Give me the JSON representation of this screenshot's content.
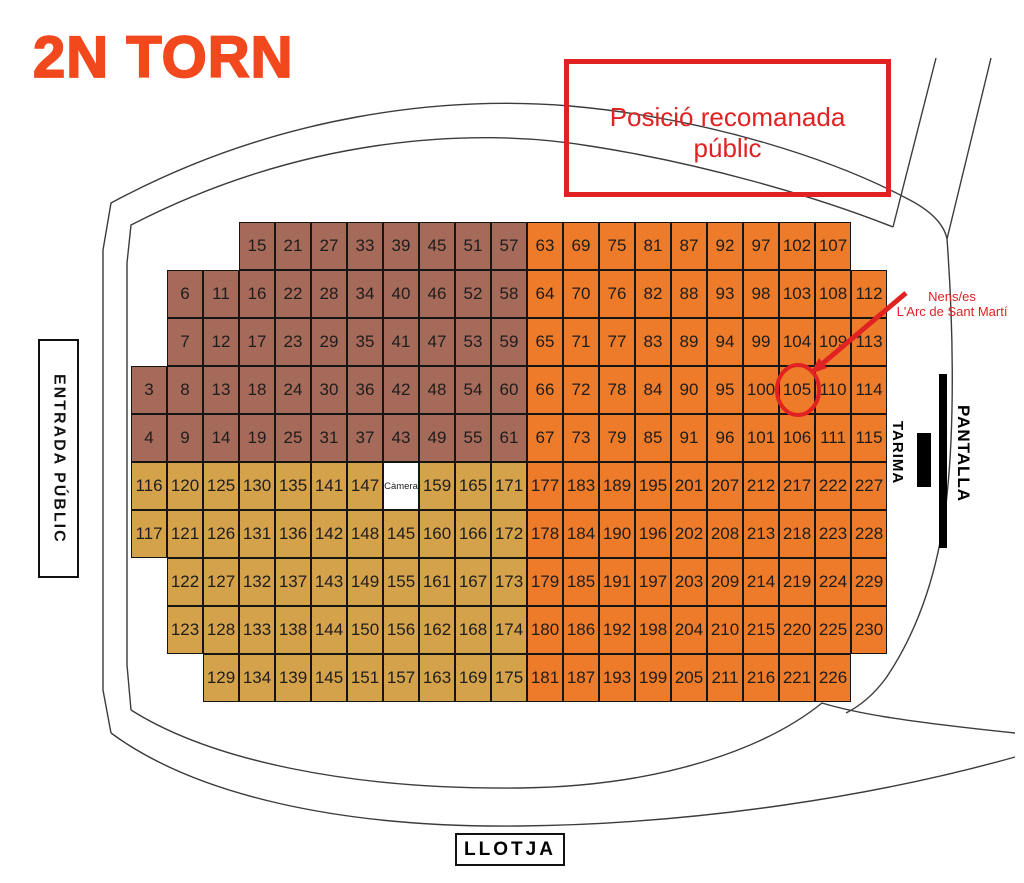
{
  "title": "2N TORN",
  "annotations": {
    "recommended_box": "Posició recomanada públic",
    "nens_line1": "Nens/es",
    "nens_line2": "L'Arc de Sant Martí",
    "circled_seat": "105"
  },
  "labels": {
    "entrance": "ENTRADA PÚBLIC",
    "tarima": "TARIMA",
    "pantalla": "PANTALLA",
    "llotja": "LLOTJA",
    "camera": "Càmera"
  },
  "colors": {
    "title": "#f2481d",
    "red": "#e02222",
    "brown": "#a66a5a",
    "orange": "#ee7b2a",
    "tan": "#d3a24b",
    "outline": "#3c3c3c"
  },
  "grid": {
    "x0": 131,
    "y0": 222,
    "cw": 36,
    "rh": 48,
    "orange_from_col": 11,
    "brown_rows": 5,
    "rows": [
      {
        "start": 3,
        "cells": [
          "15",
          "21",
          "27",
          "33",
          "39",
          "45",
          "51",
          "57",
          "63",
          "69",
          "75",
          "81",
          "87",
          "92",
          "97",
          "102",
          "107"
        ]
      },
      {
        "start": 1,
        "cells": [
          "6",
          "11",
          "16",
          "22",
          "28",
          "34",
          "40",
          "46",
          "52",
          "58",
          "64",
          "70",
          "76",
          "82",
          "88",
          "93",
          "98",
          "103",
          "108",
          "112"
        ]
      },
      {
        "start": 1,
        "cells": [
          "7",
          "12",
          "17",
          "23",
          "29",
          "35",
          "41",
          "47",
          "53",
          "59",
          "65",
          "71",
          "77",
          "83",
          "89",
          "94",
          "99",
          "104",
          "109",
          "113"
        ]
      },
      {
        "start": 0,
        "cells": [
          "3",
          "8",
          "13",
          "18",
          "24",
          "30",
          "36",
          "42",
          "48",
          "54",
          "60",
          "66",
          "72",
          "78",
          "84",
          "90",
          "95",
          "100",
          "105",
          "110",
          "114"
        ]
      },
      {
        "start": 0,
        "cells": [
          "4",
          "9",
          "14",
          "19",
          "25",
          "31",
          "37",
          "43",
          "49",
          "55",
          "61",
          "67",
          "73",
          "79",
          "85",
          "91",
          "96",
          "101",
          "106",
          "111",
          "115"
        ]
      },
      {
        "start": 0,
        "cells": [
          "116",
          "120",
          "125",
          "130",
          "135",
          "141",
          "147",
          "@camera",
          "159",
          "165",
          "171",
          "177",
          "183",
          "189",
          "195",
          "201",
          "207",
          "212",
          "217",
          "222",
          "227"
        ]
      },
      {
        "start": 0,
        "cells": [
          "117",
          "121",
          "126",
          "131",
          "136",
          "142",
          "148",
          "145",
          "160",
          "166",
          "172",
          "178",
          "184",
          "190",
          "196",
          "202",
          "208",
          "213",
          "218",
          "223",
          "228"
        ]
      },
      {
        "start": 1,
        "cells": [
          "122",
          "127",
          "132",
          "137",
          "143",
          "149",
          "155",
          "161",
          "167",
          "173",
          "179",
          "185",
          "191",
          "197",
          "203",
          "209",
          "214",
          "219",
          "224",
          "229"
        ]
      },
      {
        "start": 1,
        "cells": [
          "123",
          "128",
          "133",
          "138",
          "144",
          "150",
          "156",
          "162",
          "168",
          "174",
          "180",
          "186",
          "192",
          "198",
          "204",
          "210",
          "215",
          "220",
          "225",
          "230"
        ]
      },
      {
        "start": 2,
        "cells": [
          "129",
          "134",
          "139",
          "145",
          "151",
          "157",
          "163",
          "169",
          "175",
          "181",
          "187",
          "193",
          "199",
          "205",
          "211",
          "216",
          "221",
          "226"
        ]
      }
    ]
  }
}
